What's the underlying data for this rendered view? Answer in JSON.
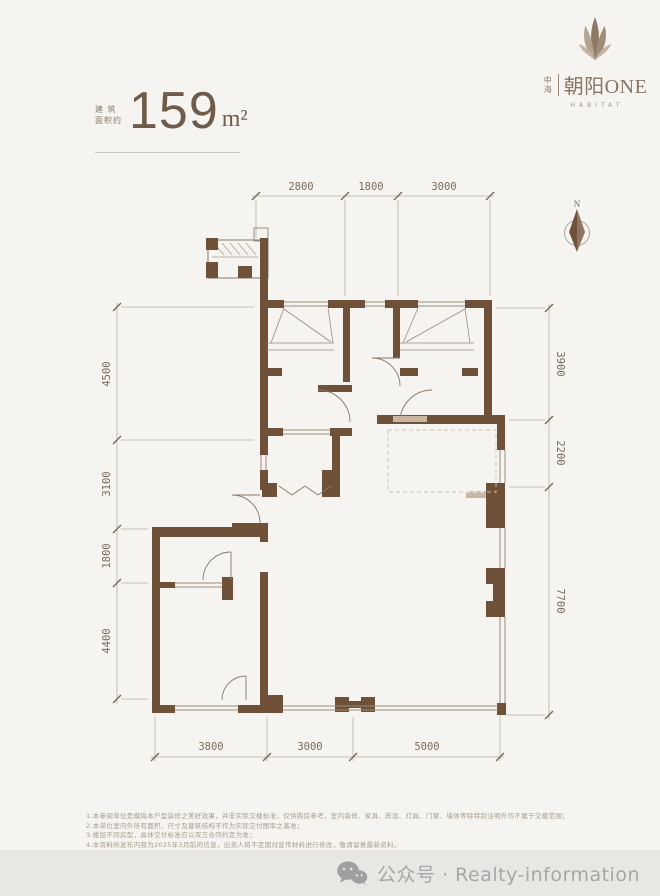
{
  "branding": {
    "developer": "中海",
    "name": "朝阳ONE",
    "tagline": "HABITAT"
  },
  "area": {
    "label_line1": "建 筑",
    "label_line2": "面积约",
    "value": "159",
    "unit": "m²"
  },
  "compass": {
    "north_label": "N"
  },
  "dimensions": {
    "top": [
      "2800",
      "1800",
      "3000"
    ],
    "left": [
      "4500",
      "3100",
      "1800",
      "4400"
    ],
    "right": [
      "3900",
      "2200",
      "7700"
    ],
    "bottom": [
      "3800",
      "3000",
      "5000"
    ]
  },
  "disclaimer": {
    "lines": [
      "1.本参阅单位是模拟本户型装修之美好效果，并非实际交楼标准，仅供购房参考，室内装修、家具、陈设、灯具、门窗、墙体等除特别注明外均不属于交楼范围；",
      "2.本单位室内外所有面积、尺寸及建筑结构不作为实际交付图审之基准；",
      "3.楼层不同房型，具体交付标准应以双方合同约定为准；",
      "4.本资料所发布内容为2025年3月前的信息，出卖人将不定期对宣传材料进行修改，敬请留意最新资料。"
    ]
  },
  "footer": {
    "icon": "wechat-official-account-icon",
    "text": "公众号 · Realty-information"
  },
  "colors": {
    "page_bg": "#f5f4f1",
    "wall": "#6f5038",
    "accent_text": "#6f5b49",
    "dimension_text": "#7b6a58",
    "logo": "#8a7563",
    "footer_bg": "#e9e7e4",
    "footer_text": "#a6a6a6"
  }
}
